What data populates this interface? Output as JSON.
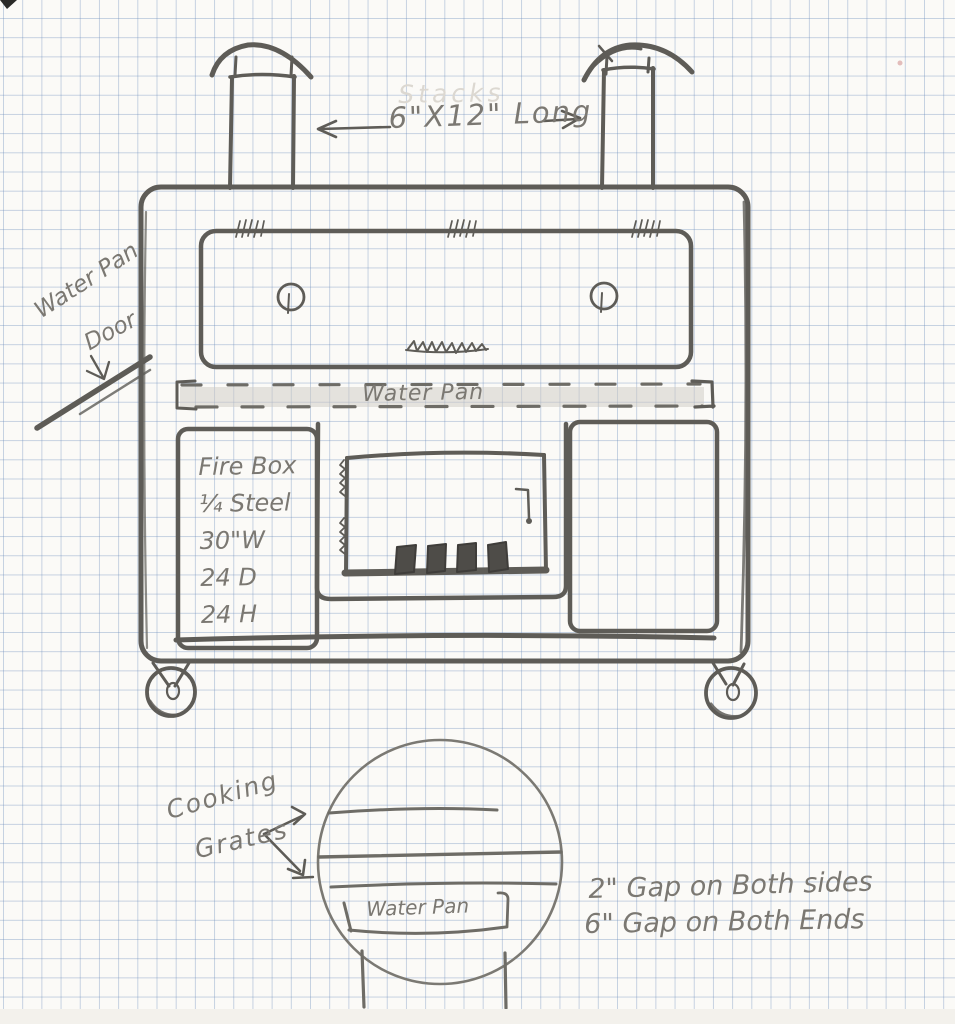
{
  "labels": {
    "stack_dimension": "6\"X12\" Long",
    "erased_note": "Stacks",
    "water_pan_door": {
      "line1": "Water Pan",
      "line2": "Door"
    },
    "water_pan_band": "Water Pan",
    "firebox_specs": [
      "Fire Box",
      "¼ Steel",
      "30\"W",
      "24 D",
      "24 H"
    ],
    "cooking_grates": {
      "line1": "Cooking",
      "line2": "Grates"
    },
    "cross_section_water_pan": "Water Pan",
    "gap_note_sides": "2\" Gap on Both sides",
    "gap_note_ends": "6\" Gap on Both Ends"
  },
  "colors": {
    "paper": "#fbfaf7",
    "grid_blue": "#8fa8c9",
    "pencil_dark": "#5e5c57",
    "pencil_light": "#7b7872",
    "band_shading": "#cdcac3"
  }
}
